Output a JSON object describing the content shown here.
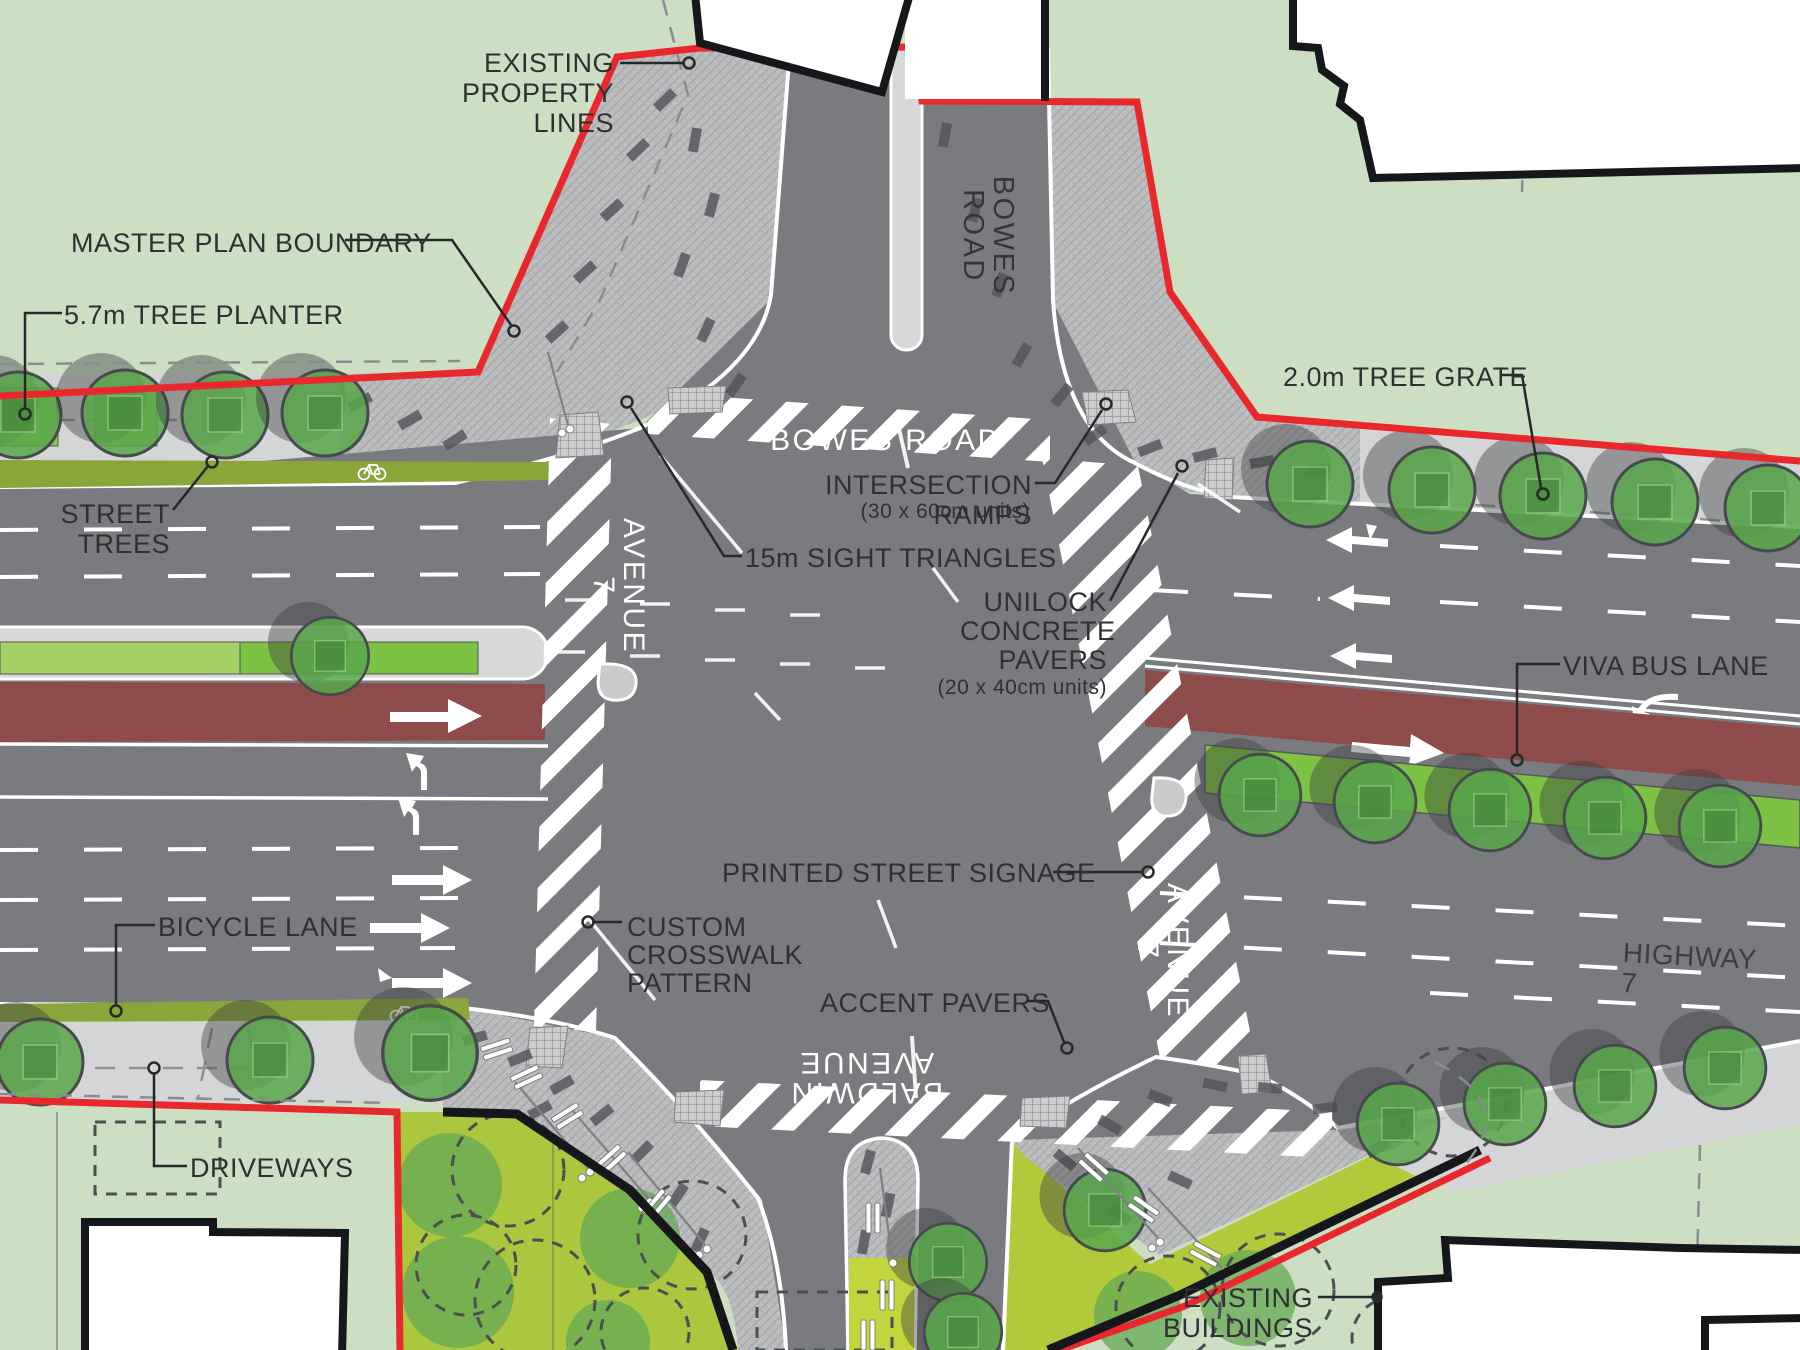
{
  "plan": {
    "type": "streetscape intersection master plan",
    "intersection": "Highway 7 / Avenue 7 at Bowes Road / Baldwin Avenue"
  },
  "colors": {
    "background_green": "#ccdfc2",
    "road_gray": "#797b7e",
    "sidewalk_gray": "#d4d5d6",
    "paver_hatch": "#bcbec0",
    "boundary_red": "#e8282d",
    "bus_lane_red": "#8d4b49",
    "bike_lane_olive": "#8aa63b",
    "planter_green_light": "#a5d166",
    "planter_green_bright": "#7dc243",
    "tree_green": "#58a74a",
    "plaza_chartreuse": "#b3c93c",
    "building_white": "#ffffff",
    "outline_black": "#15171a"
  },
  "road_labels": {
    "bowes_road_vertical": {
      "text": "BOWES ROAD"
    },
    "bowes_road_intersection": {
      "text": "BOWES ROAD"
    },
    "avenue7_west": {
      "text": "AVENUE 7"
    },
    "avenue7_east": {
      "text": "AVENUE 7"
    },
    "baldwin_avenue": {
      "text": "BALDWIN AVENUE"
    },
    "highway_7": {
      "text": "HIGHWAY 7"
    }
  },
  "labels": {
    "existing_property_lines": {
      "text": "EXISTING\nPROPERTY\nLINES"
    },
    "master_plan_boundary": {
      "text": "MASTER PLAN BOUNDARY"
    },
    "tree_planter": {
      "text": "5.7m TREE PLANTER"
    },
    "street_trees": {
      "text": "STREET\nTREES"
    },
    "tree_grate": {
      "text": "2.0m TREE GRATE"
    },
    "viva_bus_lane": {
      "text": "VIVA BUS LANE"
    },
    "bicycle_lane": {
      "text": "BICYCLE LANE"
    },
    "driveways": {
      "text": "DRIVEWAYS"
    },
    "existing_buildings": {
      "text": "EXISTING\nBUILDINGS"
    },
    "intersection_ramps": {
      "text": "INTERSECTION RAMPS",
      "sub": "(30 x 60cm units)"
    },
    "sight_triangles": {
      "text": "15m SIGHT TRIANGLES"
    },
    "unilock_pavers": {
      "text": "UNILOCK\nCONCRETE\nPAVERS",
      "sub": "(20 x 40cm units)"
    },
    "printed_street_signage": {
      "text": "PRINTED STREET SIGNAGE"
    },
    "custom_crosswalk": {
      "text": "CUSTOM\nCROSSWALK\nPATTERN"
    },
    "accent_pavers": {
      "text": "ACCENT PAVERS"
    }
  }
}
